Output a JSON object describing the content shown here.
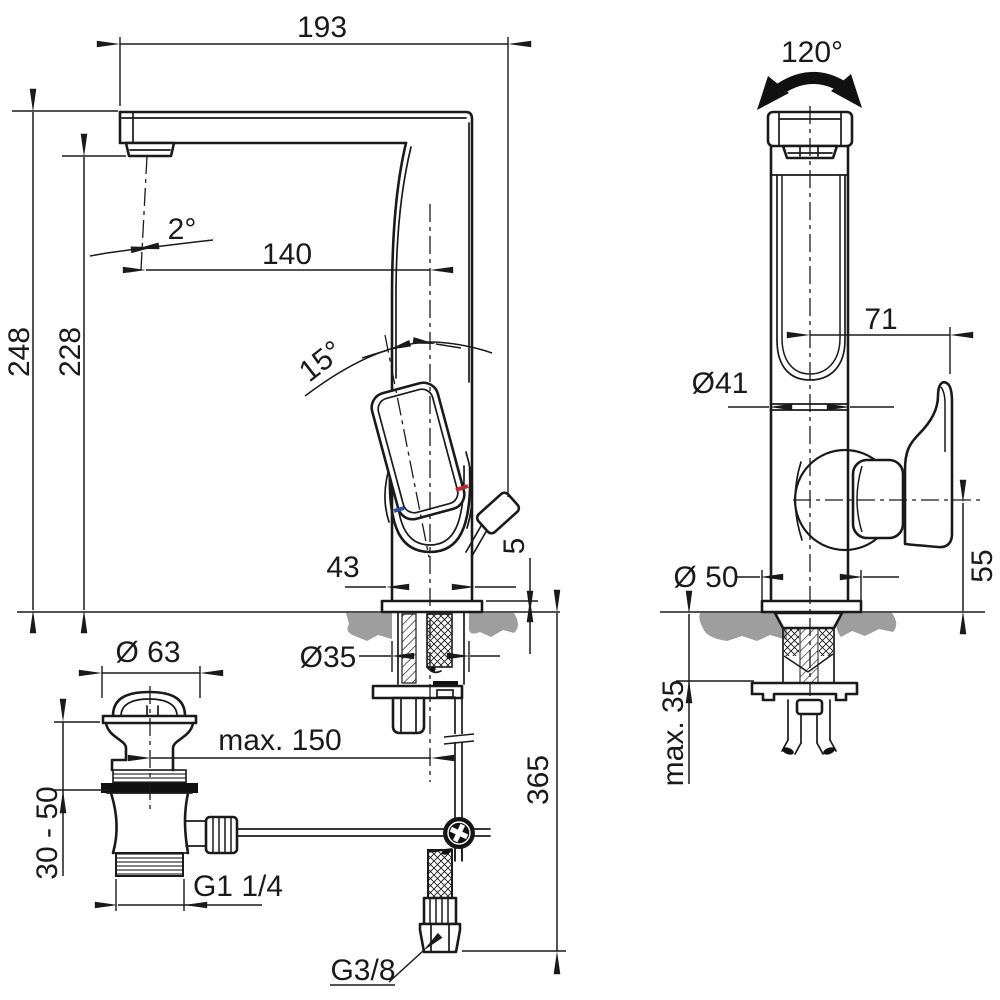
{
  "drawing": {
    "title": "basin mixer technical dimension drawing",
    "colors": {
      "line": "#1a1a1a",
      "counter": "#9e9e9e",
      "hot_mark": "#c1272d",
      "cold_mark": "#2e4fa3",
      "background": "#ffffff"
    },
    "labels": {
      "side": {
        "overall_reach": "193",
        "height": "248",
        "outlet_height": "228",
        "outlet_angle": "2°",
        "reach_to_axis": "140",
        "handle_angle": "15°",
        "body_width": "43",
        "base_height": "5",
        "hole_dia": "Ø35",
        "rod_travel": "max. 150",
        "hose_drop": "365",
        "hose_thread": "G3/8"
      },
      "front": {
        "swivel": "120°",
        "handle_offset": "71",
        "body_dia": "Ø41",
        "base_dia": "Ø 50",
        "handle_height": "55",
        "deck_max": "max. 35"
      },
      "drain": {
        "cap_dia": "Ø 63",
        "adjust_range": "30 - 50",
        "thread": "G1 1/4"
      }
    }
  }
}
